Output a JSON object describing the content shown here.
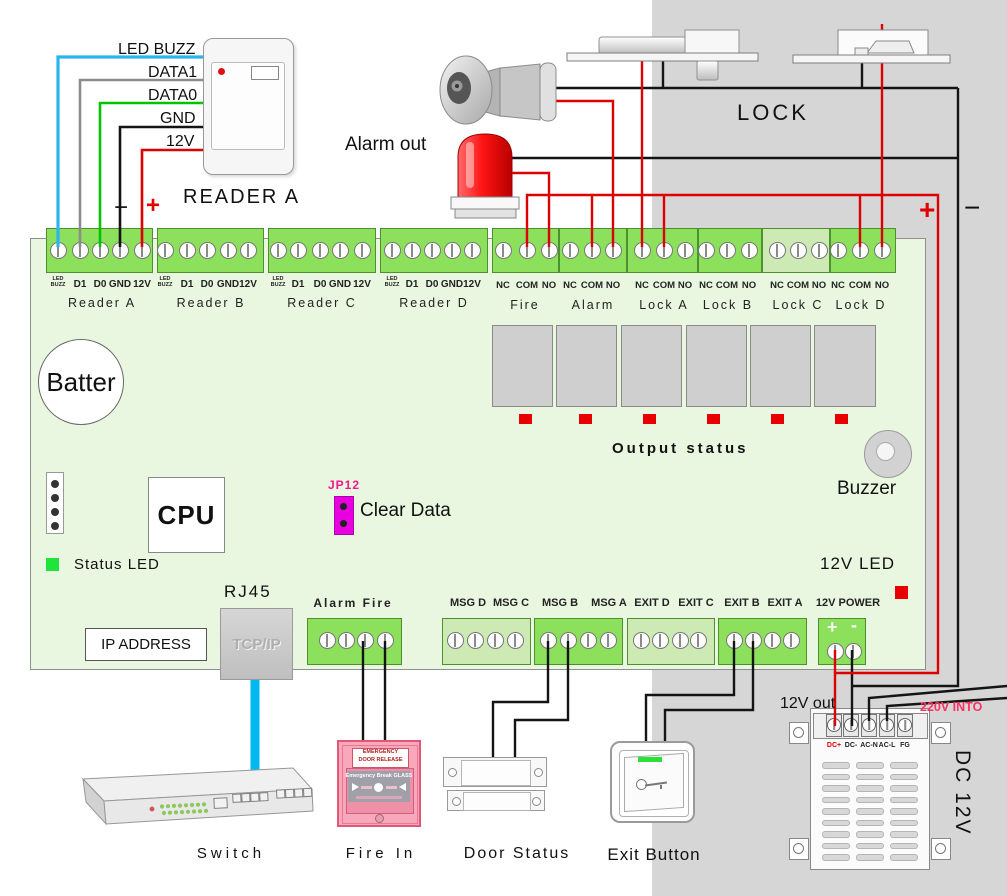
{
  "colors": {
    "wire_red": "#dd0000",
    "wire_black": "#141414",
    "wire_blue": "#00b6f0",
    "wire_green": "#00c400",
    "wire_gray": "#8c8c8c",
    "terminal_green": "#8ce05c",
    "terminal_pale": "#cde9b4",
    "board_green": "#e9f7e1",
    "background_gray": "#d6d6d6",
    "jumper_magenta": "#e800e0",
    "led_red": "#e80000",
    "led_green": "#1ee43c",
    "fire_box_pink": "#f9a8bc",
    "mains_label_pink": "#ff3366"
  },
  "reader": {
    "title": "READER A",
    "wire_labels": [
      "LED BUZZ",
      "DATA1",
      "DATA0",
      "GND",
      "12V"
    ],
    "minus": "−",
    "plus": "+"
  },
  "alarm_out": {
    "label": "Alarm out"
  },
  "lock": {
    "label": "LOCK",
    "plus": "+",
    "minus": "−"
  },
  "board": {
    "reader_pins": [
      "LED BUZZ",
      "D1",
      "D0",
      "GND",
      "12V"
    ],
    "reader_blocks": [
      {
        "name": "Reader A"
      },
      {
        "name": "Reader B"
      },
      {
        "name": "Reader C"
      },
      {
        "name": "Reader D"
      }
    ],
    "output_pins": [
      "NC",
      "COM",
      "NO"
    ],
    "output_blocks": [
      {
        "name": "Fire"
      },
      {
        "name": "Alarm"
      },
      {
        "name": "Lock A"
      },
      {
        "name": "Lock B"
      },
      {
        "name": "Lock C"
      },
      {
        "name": "Lock D"
      }
    ],
    "battery": "Batter",
    "cpu": "CPU",
    "jumper": {
      "ref": "JP12",
      "label": "Clear Data"
    },
    "status_led": "Status LED",
    "output_status": "Output status",
    "buzzer": "Buzzer",
    "led_12v": "12V LED",
    "rj45": "RJ45",
    "tcpip": "TCP/IP",
    "ip_address": "IP ADDRESS",
    "bottom": {
      "alarm_fire": "Alarm Fire",
      "msg_d": "MSG D",
      "msg_c": "MSG C",
      "msg_b": "MSG B",
      "msg_a": "MSG A",
      "exit_d": "EXIT D",
      "exit_c": "EXIT C",
      "exit_b": "EXIT B",
      "exit_a": "EXIT A",
      "power": {
        "label": "12V POWER",
        "plus": "+",
        "minus": "-"
      }
    }
  },
  "devices": {
    "switch": "Switch",
    "fire_in": {
      "label": "Fire In",
      "sign_line1": "EMERGENCY",
      "sign_line2": "DOOR RELEASE",
      "band": "Emergency Break GLASS"
    },
    "door_status": "Door Status",
    "exit_button": "Exit Button",
    "psu": {
      "label": "DC 12V",
      "terminals": [
        "DC+",
        "DC-",
        "AC-N",
        "AC-L",
        "FG"
      ],
      "out_label": "12V out",
      "mains_label": "220V INTO"
    }
  }
}
